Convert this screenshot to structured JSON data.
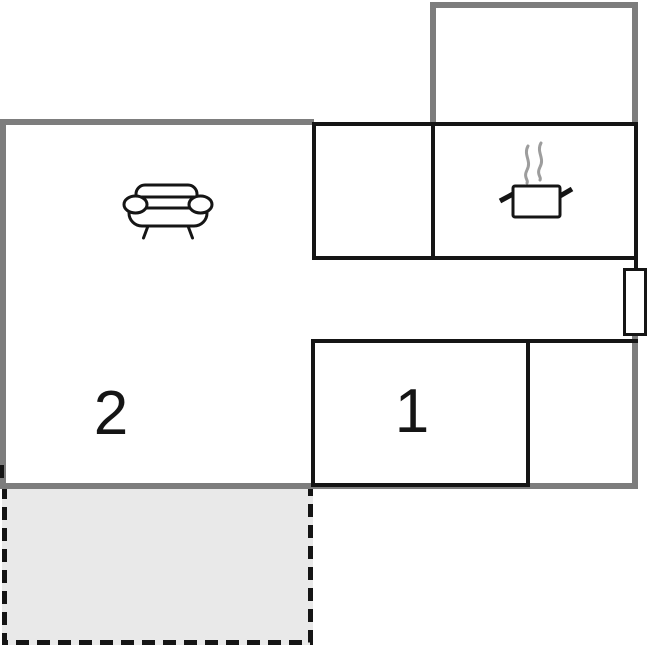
{
  "rooms": [
    {
      "id": "room-1",
      "label": "1"
    },
    {
      "id": "room-2",
      "label": "2"
    }
  ],
  "icons": [
    {
      "name": "sofa-icon"
    },
    {
      "name": "cooking-pot-icon"
    }
  ],
  "colors": {
    "wall_gray": "#7d7d7d",
    "wall_black": "#151515",
    "terrace_fill": "#e9e9e9",
    "steam_gray": "#9d9d9d",
    "background": "#ffffff"
  }
}
